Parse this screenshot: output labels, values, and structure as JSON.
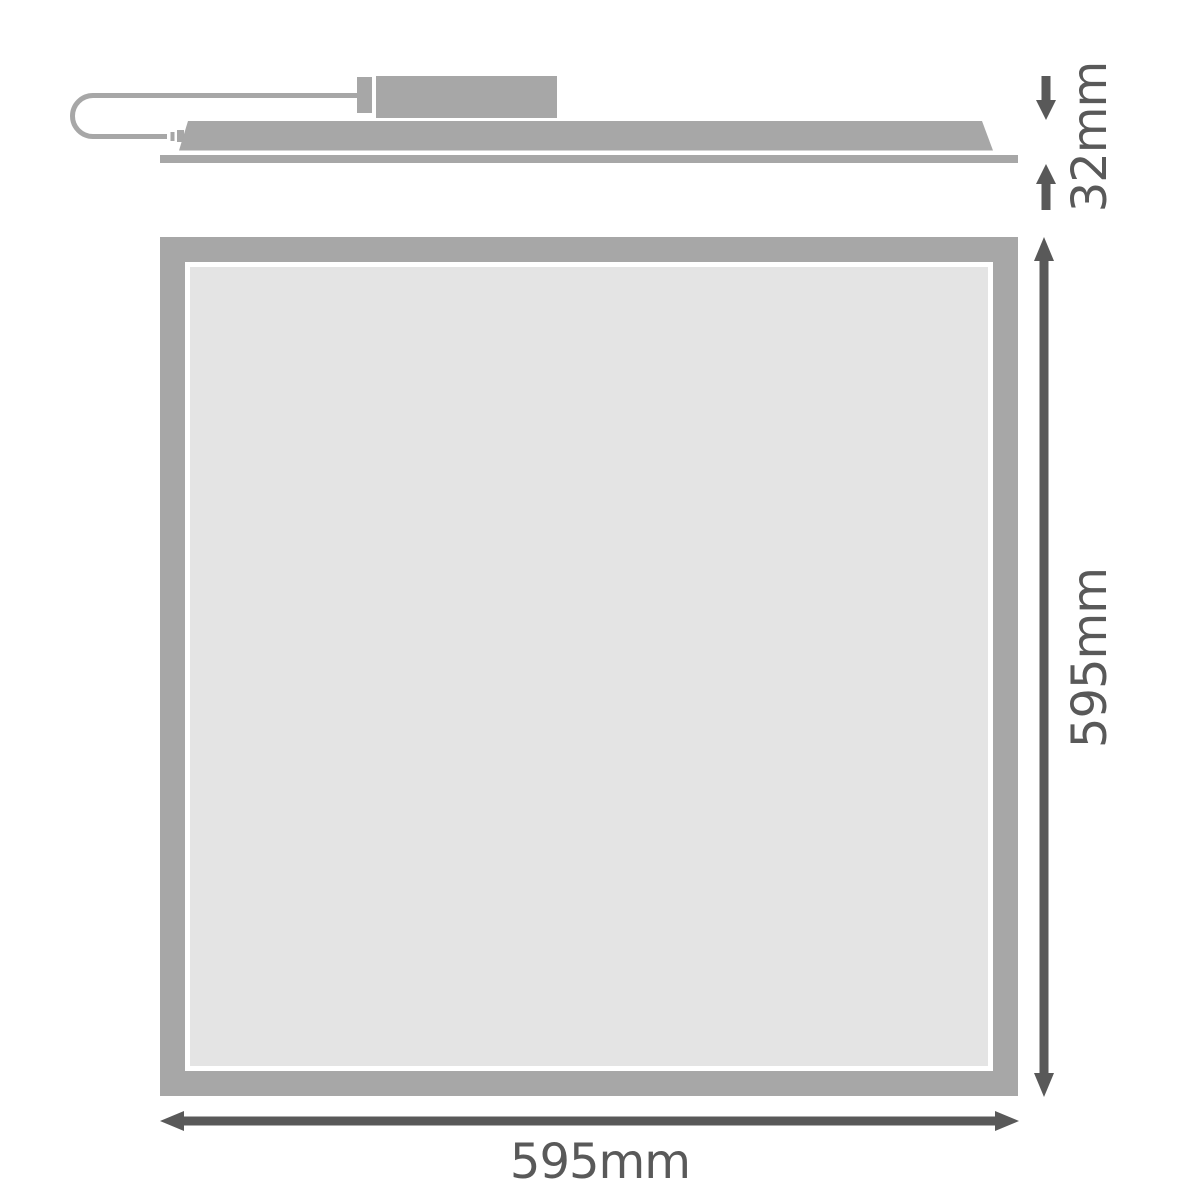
{
  "labels": {
    "depth": "32mm",
    "height": "595mm",
    "width": "595mm"
  },
  "colors": {
    "panel_gray": "#a7a7a7",
    "diffuser_gray": "#e4e4e4",
    "dimension_gray": "#595959",
    "background": "#ffffff"
  }
}
